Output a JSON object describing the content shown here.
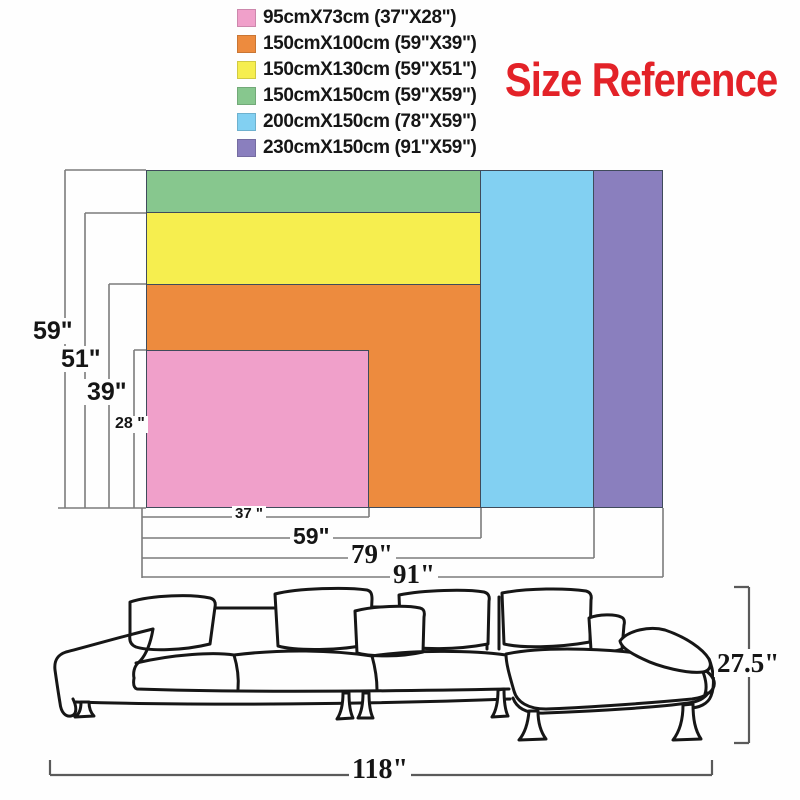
{
  "title": {
    "text": "Size Reference",
    "color": "#e32228"
  },
  "legend": {
    "items": [
      {
        "label": "95cmX73cm (37\"X28\")",
        "color": "#F0A0CA",
        "size_name": "pink"
      },
      {
        "label": "150cmX100cm (59\"X39\")",
        "color": "#ED8B3E",
        "size_name": "orange"
      },
      {
        "label": "150cmX130cm (59\"X51\")",
        "color": "#F6EE4F",
        "size_name": "yellow"
      },
      {
        "label": "150cmX150cm (59\"X59\")",
        "color": "#87C78E",
        "size_name": "green"
      },
      {
        "label": "200cmX150cm (78\"X59\")",
        "color": "#82D0F2",
        "size_name": "blue"
      },
      {
        "label": "230cmX150cm (91\"X59\")",
        "color": "#8A7FBE",
        "size_name": "purple"
      }
    ]
  },
  "diagram": {
    "heights": [
      "59\"",
      "51\"",
      "39\"",
      "28 \""
    ],
    "widths": [
      "37 \"",
      "59\"",
      "79\"",
      "91\""
    ]
  },
  "sofa": {
    "height_label": "27.5\"",
    "width_label": "118\""
  }
}
